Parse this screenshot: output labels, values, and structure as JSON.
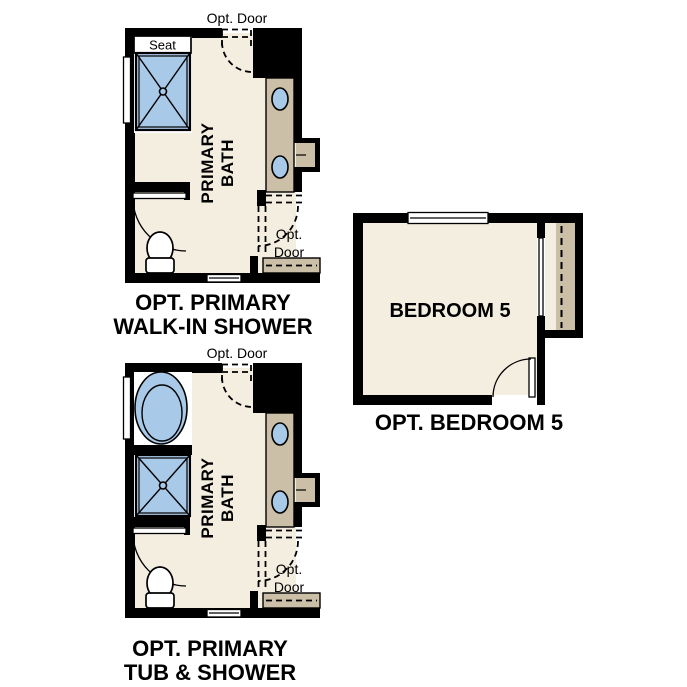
{
  "colors": {
    "wall": "#000000",
    "floor": "#f4eee1",
    "vanity_tan": "#cbbfa7",
    "fixture_blue": "#a9c9e8",
    "white": "#ffffff",
    "text": "#000000"
  },
  "plans": {
    "walk_in_shower": {
      "caption": {
        "line1": "OPT. PRIMARY",
        "line2": "WALK-IN SHOWER"
      },
      "room_label": {
        "line1": "PRIMARY",
        "line2": "BATH"
      },
      "seat_label": "Seat",
      "opt_door_top_label": "Opt. Door",
      "opt_door_side_label": {
        "line1": "Opt.",
        "line2": "Door"
      },
      "fixtures": [
        "walk-in-shower-with-seat",
        "toilet",
        "double-sink-vanity",
        "window",
        "swing-door",
        "optional-door-top",
        "optional-door-side"
      ]
    },
    "bedroom_5": {
      "caption": "OPT. BEDROOM 5",
      "room_label": "BEDROOM 5",
      "fixtures": [
        "window",
        "closet-with-rod",
        "sliding-closet-doors",
        "swing-door"
      ]
    },
    "tub_shower": {
      "caption": {
        "line1": "OPT. PRIMARY",
        "line2": "TUB & SHOWER"
      },
      "room_label": {
        "line1": "PRIMARY",
        "line2": "BATH"
      },
      "opt_door_top_label": "Opt. Door",
      "opt_door_side_label": {
        "line1": "Opt.",
        "line2": "Door"
      },
      "fixtures": [
        "bathtub",
        "shower",
        "toilet",
        "double-sink-vanity",
        "window",
        "swing-door",
        "optional-door-top",
        "optional-door-side"
      ]
    }
  }
}
